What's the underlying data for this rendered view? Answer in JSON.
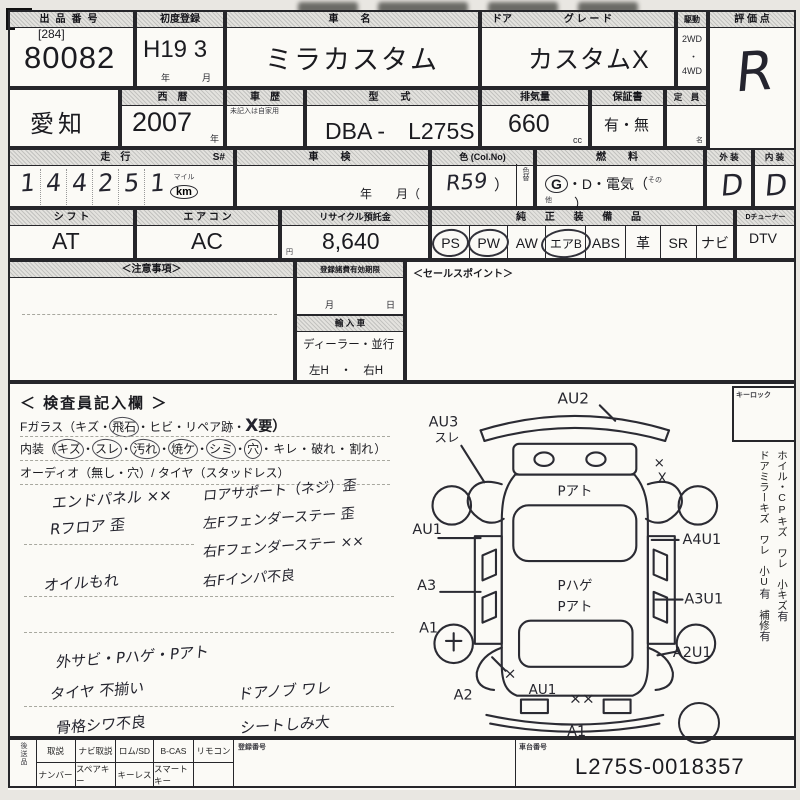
{
  "row1": {
    "lot_label": "出品番号",
    "lot_bracket": "[284]",
    "lot_number": "80082",
    "firstreg_label": "初度登録",
    "firstreg_value": "H19 3",
    "firstreg_year": "年",
    "firstreg_month": "月",
    "name_label": "車　名",
    "name_value": "ミラカスタム",
    "door_label": "ドア",
    "grade_label": "グ レ ー ド",
    "grade_value": "カスタムX",
    "drive_label": "駆動",
    "drive_2wd": "2WD",
    "drive_sep": "・",
    "drive_4wd": "4WD",
    "score_label": "評 価 点",
    "score_value": "R"
  },
  "row2": {
    "prefecture": "愛知",
    "year_label": "西　暦",
    "year_value": "2007",
    "year_unit": "年",
    "history_label": "車　歴",
    "history_note": "未記入は自家用",
    "model_label": "型　式",
    "model_value": "DBA -　L275S",
    "disp_label": "排気量",
    "disp_value": "660",
    "disp_unit": "cc",
    "warranty_label": "保証書",
    "warranty_value": "有・無",
    "capacity_label": "定　員",
    "capacity_unit": "名"
  },
  "row3": {
    "mileage_label": "走　行",
    "s_label": "S#",
    "digits": [
      "1",
      "4",
      "4",
      "2",
      "5",
      "1"
    ],
    "mile_label": "マイル",
    "km_label": "km",
    "shaken_label": "車　検",
    "shaken_units": "年　　月（",
    "color_label": "色 (Col.No)",
    "color_value": "R59",
    "color_paren": "）",
    "recolor_label": "色替",
    "fuel_label": "燃　料",
    "fuel_g": "G",
    "fuel_rest": "・D・電気（",
    "fuel_other": "その他",
    "fuel_close": "）",
    "ext_label": "外 装",
    "ext_value": "D",
    "int_label": "内 装",
    "int_value": "D"
  },
  "row4": {
    "shift_label": "シ フ ト",
    "shift_value": "AT",
    "ac_label": "エ ア コ ン",
    "ac_value": "AC",
    "recycle_label": "リサイクル預託金",
    "recycle_value": "8,640",
    "recycle_unit": "円",
    "equip_label": "純 正 装 備 品",
    "items": [
      "PS",
      "PW",
      "AW",
      "エアB",
      "ABS",
      "革",
      "SR",
      "ナビ"
    ],
    "tuner_label": "Dチューナー",
    "tuner_value": "DTV"
  },
  "mid": {
    "notice_label": "＜注意事項＞",
    "expiry_label": "登録諸費有効期限",
    "expiry_month": "月",
    "expiry_day": "日",
    "import_label": "輸 入 車",
    "import_type": "ディーラー・並行",
    "import_handle": "左H　・　右H",
    "sales_label": "＜セールスポイント＞"
  },
  "inspector": {
    "title": "＜ 検査員記入欄 ＞",
    "line1_head": "Fガラス（キズ・",
    "line1_circled": "飛石",
    "line1_mid": "・ヒビ・リペア跡・",
    "line1_hand": "X",
    "line1_tail": "要）",
    "line2_head": "内装（",
    "line2_items": [
      "キズ",
      "スレ",
      "汚れ",
      "焼ケ",
      "シミ",
      "穴",
      "キレ",
      "破れ",
      "割れ"
    ],
    "line2_sep": "・",
    "line2_tail": "）",
    "line3": "オーディオ（無し・穴）/ タイヤ（スタッドレス）",
    "notes_left": [
      "エンドパネル ××",
      "Rフロア 歪",
      "オイルもれ",
      "外サビ・Pハゲ・Pアト",
      "タイヤ 不揃い",
      "骨格シワ不良"
    ],
    "notes_right": [
      "ロアサポート（ネジ）歪",
      "左Fフェンダーステー 歪",
      "右Fフェンダーステー ××",
      "右Fインパ不良",
      "ドアノブ ワレ",
      "シートしみ大"
    ]
  },
  "diagram": {
    "front_label": "AU2",
    "front_left_label": "AU3",
    "front_left_sub": "スレ",
    "left_door_label": "AU1",
    "left_rear_door_label": "A3",
    "left_rear_wheel_label": "A1",
    "left_rear_x": "×",
    "left_rear_corner_label": "A2",
    "right_front_x1": "×",
    "right_front_x2": "X",
    "right_door_label": "A4U1",
    "right_rear_door_label": "A3U1",
    "right_rear_corner_label": "A2U1",
    "rear_panel_label": "AU1",
    "rear_panel_xx": "××",
    "rear_bumper_label": "A1",
    "interior_front": "Pアト",
    "interior_mid1": "Pハゲ",
    "interior_mid2": "Pアト"
  },
  "side": {
    "keylock_label": "キーロック",
    "v1a": "ホイル・CPキズ　ワレ",
    "v1b": "小キズ",
    "v1c": "有",
    "v2a": "ドアミラーキズ　ワレ",
    "v2b": "小U",
    "v2c": "有",
    "v2d": "補修",
    "v2e": "有"
  },
  "bottom": {
    "later_label": "後送品",
    "grid_top": [
      "取説",
      "ナビ取説",
      "ロム/SD",
      "B-CAS",
      "リモコン"
    ],
    "grid_bottom": [
      "ナンバー",
      "スペアキー",
      "キーレス",
      "スマートキー",
      ""
    ],
    "regno_label": "登録番号",
    "chassis_label": "車台番号",
    "chassis_value": "L275S-0018357"
  }
}
